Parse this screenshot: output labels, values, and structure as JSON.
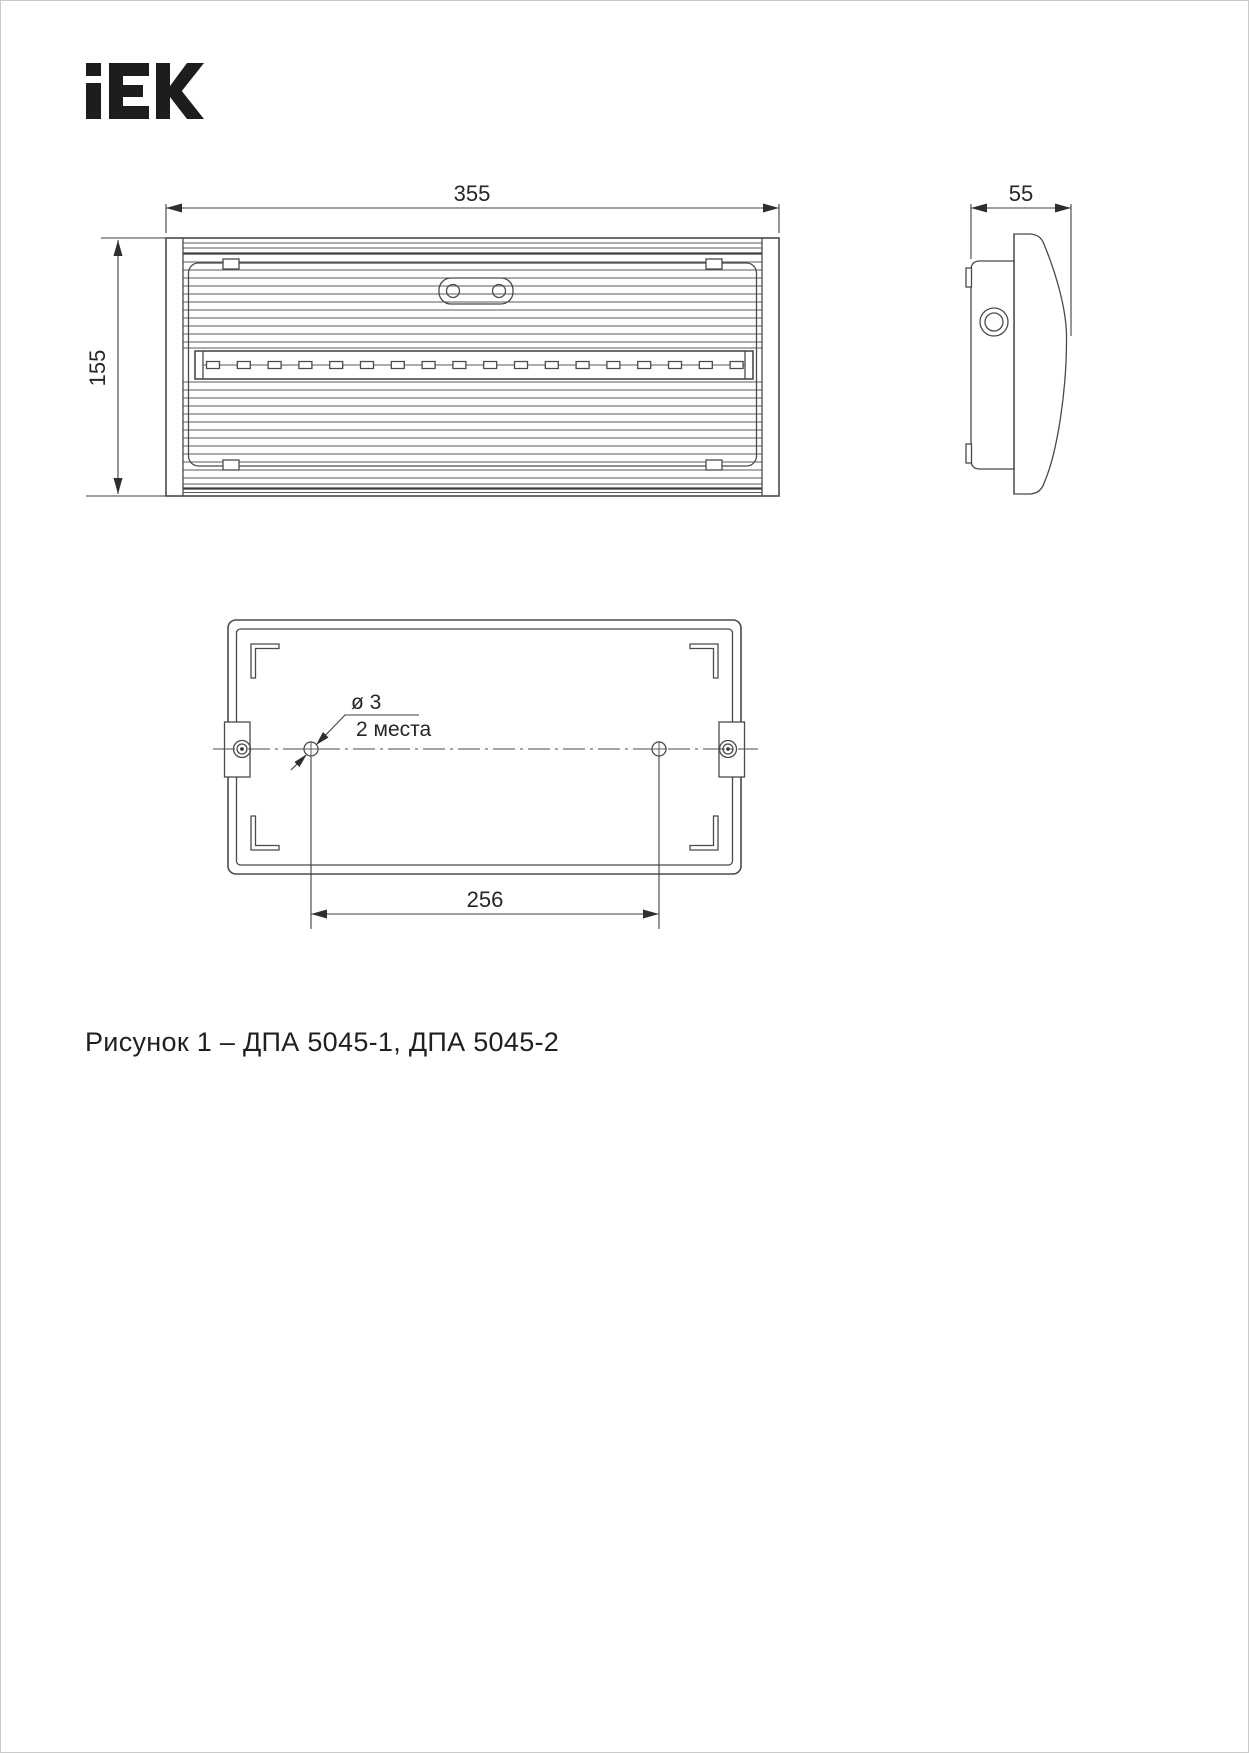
{
  "logo": {
    "name": "IEK"
  },
  "dimensions": {
    "front_width": "355",
    "front_height": "155",
    "side_depth": "55",
    "hole_diameter": "ø 3",
    "hole_places": "2 места",
    "hole_spacing": "256"
  },
  "caption": "Рисунок 1 – ДПА 5045-1, ДПА 5045-2",
  "colors": {
    "line": "#4a4a4a",
    "text": "#262626",
    "logo": "#1d1d1b",
    "background": "#ffffff"
  }
}
